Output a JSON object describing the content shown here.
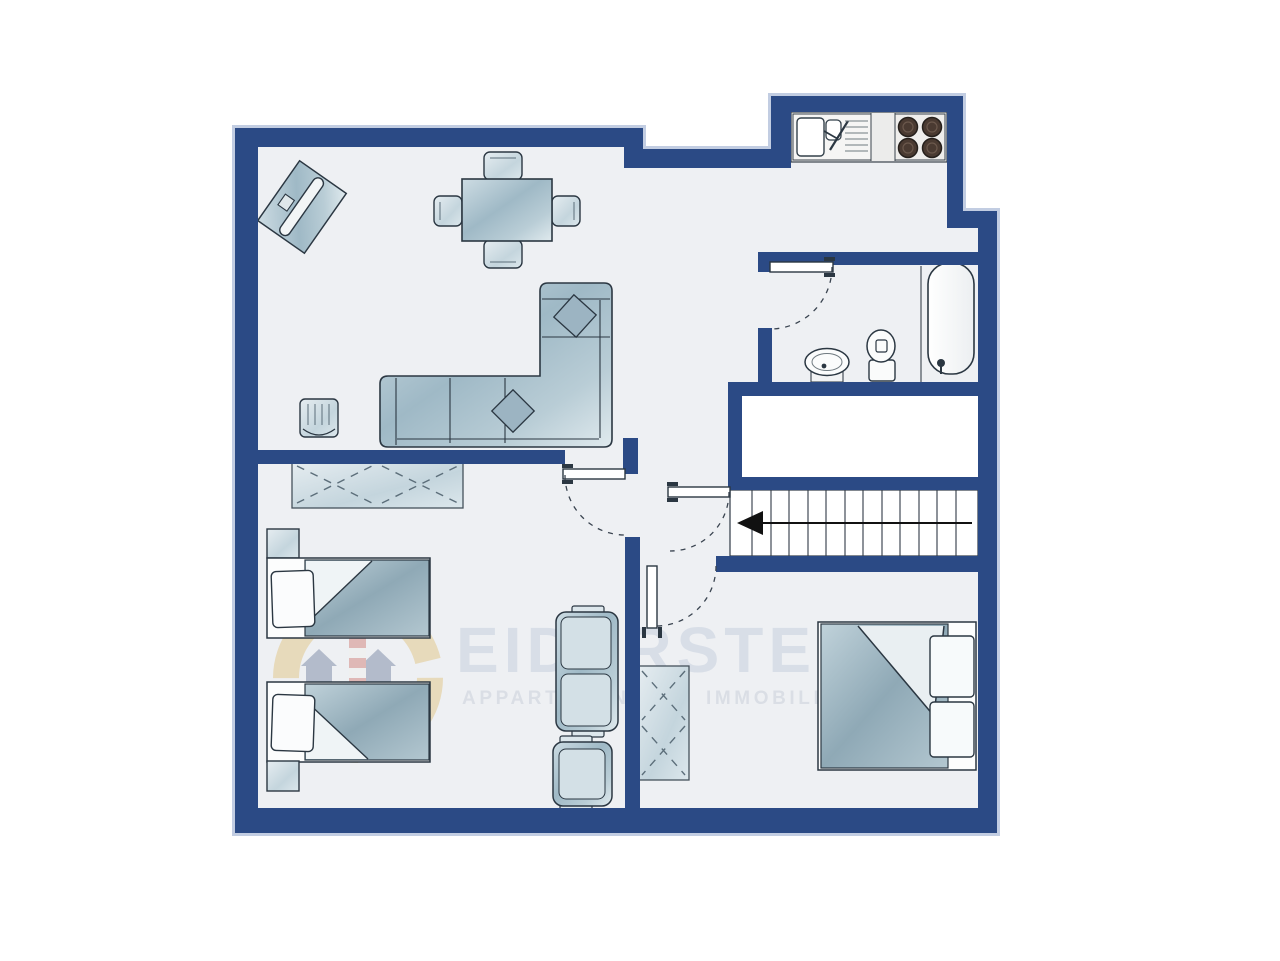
{
  "watermark": {
    "brand": "EIDERSTEDT",
    "tagline_left": "APPARTEMENTS",
    "tagline_right": "IMMOBILIEN"
  },
  "palette": {
    "wall": "#2b4a85",
    "wall_outer_outline": "#c2cde2",
    "floor": "#eef0f3",
    "void_area": "#ffffff",
    "furniture_steel": "#a9c2cf",
    "furniture_light": "#dde8ed",
    "blanket": "#9db5c1",
    "fixture_white": "#fafbfc",
    "line_outline": "#2b3742",
    "stair_arrow": "#111111",
    "burner": "#4a3a31",
    "logo_yellow": "#d9a93c",
    "logo_red": "#c03a2c",
    "logo_navy": "#2e4570",
    "watermark_text": "#ccd4e1"
  }
}
